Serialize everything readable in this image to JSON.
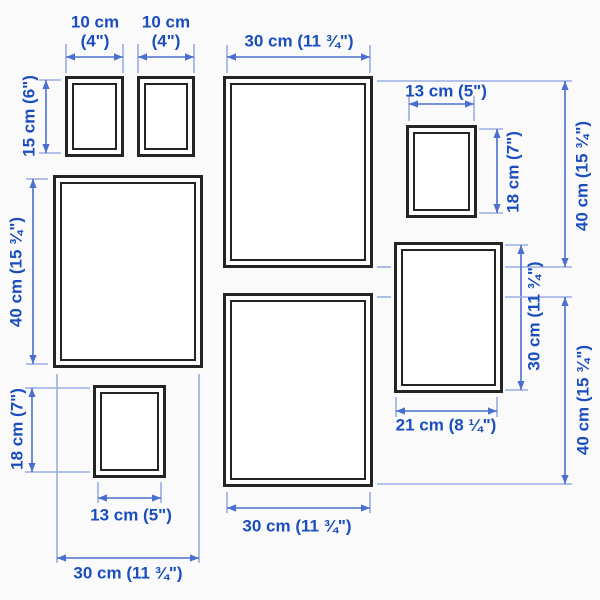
{
  "diagram": {
    "title": "Picture frame set wall-arrangement dimension diagram",
    "background": "#fafafa",
    "colors": {
      "text": "#1a4dbd",
      "arrow_line": "#4a6fd0",
      "extension_line": "#9aade4",
      "frame_border": "#242424",
      "frame_fill": "#ffffff"
    },
    "frames": [
      {
        "name": "frame-10x15-top-left",
        "x": 65,
        "y": 76,
        "w": 59,
        "h": 81
      },
      {
        "name": "frame-10x15-top-right",
        "x": 137,
        "y": 76,
        "w": 58,
        "h": 81
      },
      {
        "name": "frame-30x40-top",
        "x": 223,
        "y": 76,
        "w": 150,
        "h": 192
      },
      {
        "name": "frame-13x18-right",
        "x": 406,
        "y": 125,
        "w": 71,
        "h": 93
      },
      {
        "name": "frame-30x40-left",
        "x": 53,
        "y": 175,
        "w": 150,
        "h": 193
      },
      {
        "name": "frame-21x30-right",
        "x": 394,
        "y": 242,
        "w": 109,
        "h": 151
      },
      {
        "name": "frame-13x18-bottom",
        "x": 93,
        "y": 385,
        "w": 73,
        "h": 93
      },
      {
        "name": "frame-30x40-bottom",
        "x": 223,
        "y": 293,
        "w": 150,
        "h": 194
      }
    ],
    "dimensions": [
      {
        "name": "dim-width-10cm-a",
        "label": "10 cm\n(4\")",
        "orientation": "h",
        "line": {
          "x1": 66,
          "y1": 57,
          "x2": 123,
          "y2": 57
        },
        "label_center": {
          "x": 95,
          "y": 32
        },
        "extensions": [
          {
            "x1": 66,
            "y1": 44,
            "x2": 66,
            "y2": 73
          },
          {
            "x1": 123,
            "y1": 44,
            "x2": 123,
            "y2": 73
          }
        ]
      },
      {
        "name": "dim-width-10cm-b",
        "label": "10 cm\n(4\")",
        "orientation": "h",
        "line": {
          "x1": 138,
          "y1": 57,
          "x2": 194,
          "y2": 57
        },
        "label_center": {
          "x": 166,
          "y": 32
        },
        "extensions": [
          {
            "x1": 138,
            "y1": 44,
            "x2": 138,
            "y2": 73
          },
          {
            "x1": 194,
            "y1": 44,
            "x2": 194,
            "y2": 73
          }
        ]
      },
      {
        "name": "dim-width-30cm-top",
        "label": "30 cm (11 ¾\")",
        "orientation": "h",
        "line": {
          "x1": 227,
          "y1": 57,
          "x2": 370,
          "y2": 57
        },
        "label_center": {
          "x": 299,
          "y": 42
        },
        "extensions": [
          {
            "x1": 227,
            "y1": 45,
            "x2": 227,
            "y2": 73
          },
          {
            "x1": 370,
            "y1": 45,
            "x2": 370,
            "y2": 73
          }
        ]
      },
      {
        "name": "dim-height-15cm",
        "label": "15 cm (6\")",
        "orientation": "v",
        "line": {
          "x1": 46,
          "y1": 80,
          "x2": 46,
          "y2": 153
        },
        "label_center": {
          "x": 30,
          "y": 116
        },
        "extensions": [
          {
            "x1": 39,
            "y1": 80,
            "x2": 61,
            "y2": 80
          },
          {
            "x1": 39,
            "y1": 153,
            "x2": 61,
            "y2": 153
          }
        ]
      },
      {
        "name": "dim-width-13cm-top",
        "label": "13 cm (5\")",
        "orientation": "h",
        "line": {
          "x1": 409,
          "y1": 104,
          "x2": 474,
          "y2": 104
        },
        "label_center": {
          "x": 446,
          "y": 92
        },
        "extensions": [
          {
            "x1": 409,
            "y1": 96,
            "x2": 409,
            "y2": 121
          },
          {
            "x1": 474,
            "y1": 96,
            "x2": 474,
            "y2": 121
          }
        ]
      },
      {
        "name": "dim-height-40cm-top-right",
        "label": "40 cm (15 ¾\")",
        "orientation": "v",
        "line": {
          "x1": 565,
          "y1": 81,
          "x2": 565,
          "y2": 267
        },
        "label_center": {
          "x": 583,
          "y": 176
        },
        "extensions": [
          {
            "x1": 377,
            "y1": 81,
            "x2": 572,
            "y2": 81
          },
          {
            "x1": 377,
            "y1": 267,
            "x2": 391,
            "y2": 267
          },
          {
            "x1": 505,
            "y1": 267,
            "x2": 572,
            "y2": 267
          }
        ]
      },
      {
        "name": "dim-height-18cm-right",
        "label": "18 cm (7\")",
        "orientation": "v",
        "line": {
          "x1": 497,
          "y1": 129,
          "x2": 497,
          "y2": 213
        },
        "label_center": {
          "x": 514,
          "y": 172
        },
        "extensions": [
          {
            "x1": 479,
            "y1": 129,
            "x2": 503,
            "y2": 129
          },
          {
            "x1": 479,
            "y1": 213,
            "x2": 503,
            "y2": 213
          }
        ]
      },
      {
        "name": "dim-height-40cm-left",
        "label": "40 cm (15 ¾\")",
        "orientation": "v",
        "line": {
          "x1": 33,
          "y1": 179,
          "x2": 33,
          "y2": 364
        },
        "label_center": {
          "x": 17,
          "y": 272
        },
        "extensions": [
          {
            "x1": 26,
            "y1": 179,
            "x2": 48,
            "y2": 179
          },
          {
            "x1": 26,
            "y1": 364,
            "x2": 48,
            "y2": 364
          }
        ]
      },
      {
        "name": "dim-height-30cm-right",
        "label": "30 cm (11 ¾\")",
        "orientation": "v",
        "line": {
          "x1": 521,
          "y1": 245,
          "x2": 521,
          "y2": 390
        },
        "label_center": {
          "x": 535,
          "y": 316
        },
        "extensions": [
          {
            "x1": 505,
            "y1": 245,
            "x2": 528,
            "y2": 245
          },
          {
            "x1": 505,
            "y1": 390,
            "x2": 528,
            "y2": 390
          }
        ]
      },
      {
        "name": "dim-height-40cm-bottom-right",
        "label": "40 cm (15 ¾\")",
        "orientation": "v",
        "line": {
          "x1": 565,
          "y1": 297,
          "x2": 565,
          "y2": 484
        },
        "label_center": {
          "x": 584,
          "y": 400
        },
        "extensions": [
          {
            "x1": 377,
            "y1": 297,
            "x2": 391,
            "y2": 297
          },
          {
            "x1": 505,
            "y1": 297,
            "x2": 572,
            "y2": 297
          },
          {
            "x1": 377,
            "y1": 484,
            "x2": 572,
            "y2": 484
          }
        ]
      },
      {
        "name": "dim-width-21cm",
        "label": "21 cm (8 ¼\")",
        "orientation": "h",
        "line": {
          "x1": 396,
          "y1": 411,
          "x2": 497,
          "y2": 411
        },
        "label_center": {
          "x": 446,
          "y": 426
        },
        "extensions": [
          {
            "x1": 396,
            "y1": 397,
            "x2": 396,
            "y2": 417
          },
          {
            "x1": 497,
            "y1": 397,
            "x2": 497,
            "y2": 417
          }
        ]
      },
      {
        "name": "dim-height-18cm-bottom-left",
        "label": "18 cm (7\")",
        "orientation": "v",
        "line": {
          "x1": 32,
          "y1": 388,
          "x2": 32,
          "y2": 472
        },
        "label_center": {
          "x": 18,
          "y": 429
        },
        "extensions": [
          {
            "x1": 25,
            "y1": 388,
            "x2": 90,
            "y2": 388
          },
          {
            "x1": 25,
            "y1": 472,
            "x2": 90,
            "y2": 472
          }
        ]
      },
      {
        "name": "dim-width-13cm-bottom",
        "label": "13 cm (5\")",
        "orientation": "h",
        "line": {
          "x1": 98,
          "y1": 498,
          "x2": 161,
          "y2": 498
        },
        "label_center": {
          "x": 131,
          "y": 516
        },
        "extensions": [
          {
            "x1": 98,
            "y1": 482,
            "x2": 98,
            "y2": 503
          },
          {
            "x1": 161,
            "y1": 482,
            "x2": 161,
            "y2": 503
          }
        ]
      },
      {
        "name": "dim-width-30cm-bottom-middle",
        "label": "30 cm (11 ¾\")",
        "orientation": "h",
        "line": {
          "x1": 227,
          "y1": 508,
          "x2": 370,
          "y2": 508
        },
        "label_center": {
          "x": 297,
          "y": 527
        },
        "extensions": [
          {
            "x1": 227,
            "y1": 492,
            "x2": 227,
            "y2": 513
          },
          {
            "x1": 370,
            "y1": 492,
            "x2": 370,
            "y2": 513
          }
        ]
      },
      {
        "name": "dim-width-30cm-bottom-left",
        "label": "30 cm (11 ¾\")",
        "orientation": "h",
        "line": {
          "x1": 57,
          "y1": 558,
          "x2": 199,
          "y2": 558
        },
        "label_center": {
          "x": 128,
          "y": 574
        },
        "extensions": [
          {
            "x1": 57,
            "y1": 374,
            "x2": 57,
            "y2": 563
          },
          {
            "x1": 199,
            "y1": 374,
            "x2": 199,
            "y2": 563
          }
        ]
      }
    ]
  }
}
